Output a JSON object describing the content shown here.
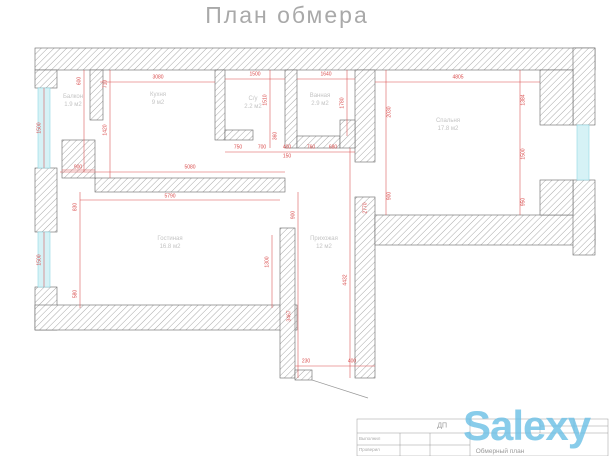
{
  "title": "План обмера",
  "plan": {
    "rooms": [
      {
        "name": "Балкон",
        "area": "1.9 м2",
        "x": 73,
        "y": 102
      },
      {
        "name": "Кухня",
        "area": "9 м2",
        "x": 158,
        "y": 100
      },
      {
        "name": "С/у",
        "area": "2.2 м2",
        "x": 253,
        "y": 104
      },
      {
        "name": "Ванная",
        "area": "2.9 м2",
        "x": 320,
        "y": 101
      },
      {
        "name": "Спальня",
        "area": "17.8 м2",
        "x": 448,
        "y": 126
      },
      {
        "name": "Гостиная",
        "area": "16.8 м2",
        "x": 170,
        "y": 244
      },
      {
        "name": "Прихожая",
        "area": "12 м2",
        "x": 324,
        "y": 244
      }
    ],
    "dimensions": [
      {
        "t": "3080",
        "x": 158,
        "y": 78,
        "r": 0
      },
      {
        "t": "1500",
        "x": 255,
        "y": 75,
        "r": 0
      },
      {
        "t": "1640",
        "x": 326,
        "y": 75,
        "r": 0
      },
      {
        "t": "4805",
        "x": 458,
        "y": 78,
        "r": 0
      },
      {
        "t": "710",
        "x": 106,
        "y": 84,
        "r": 1
      },
      {
        "t": "1420",
        "x": 106,
        "y": 130,
        "r": 1
      },
      {
        "t": "600",
        "x": 80,
        "y": 81,
        "r": 1
      },
      {
        "t": "1500",
        "x": 40,
        "y": 128,
        "r": 1
      },
      {
        "t": "1500",
        "x": 40,
        "y": 260,
        "r": 1
      },
      {
        "t": "830",
        "x": 76,
        "y": 207,
        "r": 1
      },
      {
        "t": "580",
        "x": 76,
        "y": 294,
        "r": 1
      },
      {
        "t": "900",
        "x": 78,
        "y": 168,
        "r": 0
      },
      {
        "t": "1510",
        "x": 266,
        "y": 100,
        "r": 1
      },
      {
        "t": "360",
        "x": 276,
        "y": 136,
        "r": 1
      },
      {
        "t": "1780",
        "x": 343,
        "y": 103,
        "r": 1
      },
      {
        "t": "750",
        "x": 238,
        "y": 148,
        "r": 0
      },
      {
        "t": "700",
        "x": 262,
        "y": 148,
        "r": 0
      },
      {
        "t": "400",
        "x": 287,
        "y": 148,
        "r": 0
      },
      {
        "t": "150",
        "x": 287,
        "y": 157,
        "r": 0
      },
      {
        "t": "760",
        "x": 311,
        "y": 148,
        "r": 0
      },
      {
        "t": "680",
        "x": 333,
        "y": 148,
        "r": 0
      },
      {
        "t": "5080",
        "x": 190,
        "y": 168,
        "r": 0
      },
      {
        "t": "5790",
        "x": 170,
        "y": 197,
        "r": 0
      },
      {
        "t": "2030",
        "x": 390,
        "y": 112,
        "r": 1
      },
      {
        "t": "900",
        "x": 390,
        "y": 196,
        "r": 1
      },
      {
        "t": "1384",
        "x": 524,
        "y": 100,
        "r": 1
      },
      {
        "t": "1500",
        "x": 524,
        "y": 154,
        "r": 1
      },
      {
        "t": "950",
        "x": 524,
        "y": 202,
        "r": 1
      },
      {
        "t": "1300",
        "x": 268,
        "y": 262,
        "r": 1
      },
      {
        "t": "900",
        "x": 294,
        "y": 215,
        "r": 1
      },
      {
        "t": "3467",
        "x": 290,
        "y": 316,
        "r": 1
      },
      {
        "t": "4432",
        "x": 346,
        "y": 280,
        "r": 1
      },
      {
        "t": "2770",
        "x": 366,
        "y": 208,
        "r": 1
      },
      {
        "t": "230",
        "x": 306,
        "y": 362,
        "r": 0
      },
      {
        "t": "400",
        "x": 352,
        "y": 362,
        "r": 0
      }
    ]
  },
  "title_block": {
    "code": "ДП",
    "executor_label": "Выполнил",
    "checker_label": "Проверил",
    "doc_title": "Обмерный план"
  },
  "watermark": {
    "text": "Salexy",
    "color": "#6ec1e6"
  },
  "colors": {
    "dimension_red": "#d94c4c",
    "window_cyan": "#d6f2f6",
    "window_frame": "#8fd8e4",
    "wall_outline": "#666666",
    "hatch_gray": "#9f9f9f",
    "label_gray": "#c4c4c4",
    "watermark_blue": "#6ec1e6"
  }
}
